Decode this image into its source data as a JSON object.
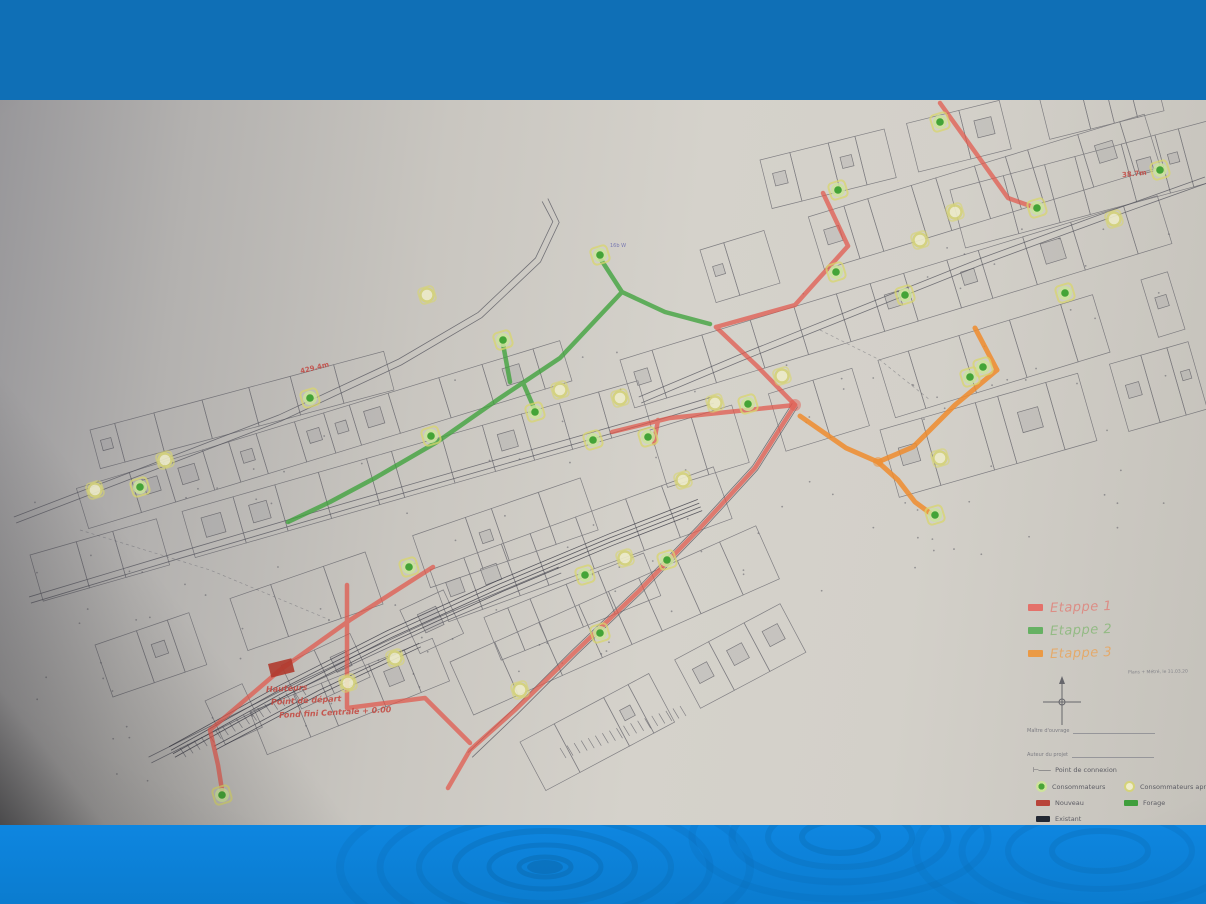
{
  "slide": {
    "top_band_color": "#0f6fb6",
    "bottom_band_color": "#0d84dc",
    "paper_color": "#d3d0c9"
  },
  "handwritten_legend": {
    "items": [
      {
        "label": "Etappe 1",
        "color": "#e8625a",
        "text_color": "#e4746c"
      },
      {
        "label": "Etappe 2",
        "color": "#53ad52",
        "text_color": "#7cb56b"
      },
      {
        "label": "Etappe 3",
        "color": "#f0922f",
        "text_color": "#ef9e47"
      }
    ]
  },
  "printed_legend": {
    "note": "Plans + Métré, le 31.03.20",
    "fields": [
      {
        "label": "Maître d'ouvrage"
      },
      {
        "label": "Auteur du projet"
      }
    ],
    "items": [
      {
        "symbol": "connection",
        "label": "Point de connexion"
      },
      {
        "symbol": "consumer-green",
        "label": "Consommateurs"
      },
      {
        "symbol": "consumer-yellow",
        "label": "Consommateurs apr"
      },
      {
        "symbol": "swatch-red",
        "label": "Nouveau",
        "color": "#b8443a"
      },
      {
        "symbol": "swatch-green",
        "label": "Forage",
        "color": "#3f9e3c"
      },
      {
        "symbol": "swatch-black",
        "label": "Existant",
        "color": "#222833"
      }
    ]
  },
  "annotations": {
    "red_notes": [
      {
        "text": "Hauteurs",
        "x": 266,
        "y": 584
      },
      {
        "text": "Point de départ",
        "x": 271,
        "y": 596
      },
      {
        "text": "Fond fini Centrale + 0.00",
        "x": 279,
        "y": 608
      }
    ],
    "measurements": [
      {
        "text": "429.4m",
        "x": 300,
        "y": 264,
        "rot": -14
      },
      {
        "text": "38.7m",
        "x": 1122,
        "y": 70,
        "rot": -6
      }
    ],
    "node_label": {
      "text": "16b W",
      "x": 610,
      "y": 143
    }
  },
  "map": {
    "reservoir_rect": {
      "x": 268,
      "y": 564,
      "w": 24,
      "h": 14,
      "color": "#b03a2e"
    },
    "routes": {
      "red": {
        "color": "#e2574b",
        "paths": [
          [
            [
              940,
              3
            ],
            [
              1008,
              98
            ],
            [
              1036,
              108
            ]
          ],
          [
            [
              823,
              93
            ],
            [
              848,
              146
            ]
          ],
          [
            [
              848,
              146
            ],
            [
              795,
              205
            ],
            [
              716,
              227
            ]
          ],
          [
            [
              716,
              227
            ],
            [
              757,
              266
            ],
            [
              795,
              305
            ]
          ],
          [
            [
              795,
              305
            ],
            [
              670,
              318
            ],
            [
              612,
              332
            ]
          ],
          [
            [
              658,
              320
            ],
            [
              654,
              343
            ]
          ],
          [
            [
              795,
              305
            ],
            [
              755,
              368
            ],
            [
              700,
              428
            ],
            [
              638,
              492
            ],
            [
              575,
              552
            ],
            [
              515,
              610
            ],
            [
              470,
              650
            ],
            [
              448,
              688
            ]
          ],
          [
            [
              347,
              485
            ],
            [
              347,
              608
            ],
            [
              425,
              598
            ],
            [
              470,
              643
            ]
          ],
          [
            [
              433,
              467
            ],
            [
              350,
              520
            ],
            [
              280,
              570
            ],
            [
              210,
              630
            ]
          ],
          [
            [
              210,
              630
            ],
            [
              218,
              665
            ],
            [
              222,
              690
            ]
          ]
        ]
      },
      "green": {
        "color": "#3fa33c",
        "paths": [
          [
            [
              600,
              158
            ],
            [
              622,
              192
            ],
            [
              665,
              212
            ],
            [
              710,
              224
            ]
          ],
          [
            [
              622,
              192
            ],
            [
              560,
              258
            ],
            [
              500,
              298
            ],
            [
              437,
              342
            ],
            [
              375,
              378
            ],
            [
              330,
              402
            ],
            [
              288,
              422
            ]
          ],
          [
            [
              503,
              244
            ],
            [
              510,
              282
            ]
          ],
          [
            [
              524,
              285
            ],
            [
              534,
              308
            ]
          ]
        ]
      },
      "orange": {
        "color": "#f08c2e",
        "paths": [
          [
            [
              975,
              228
            ],
            [
              997,
              270
            ]
          ],
          [
            [
              997,
              270
            ],
            [
              955,
              305
            ],
            [
              913,
              347
            ],
            [
              878,
              362
            ],
            [
              846,
              348
            ],
            [
              800,
              316
            ]
          ],
          [
            [
              878,
              362
            ],
            [
              898,
              380
            ],
            [
              915,
              402
            ],
            [
              930,
              413
            ]
          ]
        ]
      }
    },
    "nodes_green": [
      [
        222,
        695
      ],
      [
        140,
        387
      ],
      [
        310,
        298
      ],
      [
        431,
        336
      ],
      [
        503,
        240
      ],
      [
        535,
        312
      ],
      [
        600,
        155
      ],
      [
        648,
        337
      ],
      [
        593,
        340
      ],
      [
        409,
        467
      ],
      [
        585,
        475
      ],
      [
        600,
        533
      ],
      [
        667,
        460
      ],
      [
        836,
        172
      ],
      [
        838,
        90
      ],
      [
        940,
        22
      ],
      [
        1037,
        108
      ],
      [
        935,
        415
      ],
      [
        1065,
        193
      ],
      [
        970,
        277
      ],
      [
        983,
        267
      ],
      [
        905,
        195
      ],
      [
        748,
        304
      ],
      [
        1160,
        70
      ]
    ],
    "nodes_yellow": [
      [
        95,
        390
      ],
      [
        165,
        360
      ],
      [
        427,
        195
      ],
      [
        560,
        290
      ],
      [
        620,
        298
      ],
      [
        683,
        380
      ],
      [
        715,
        303
      ],
      [
        782,
        276
      ],
      [
        920,
        140
      ],
      [
        955,
        112
      ],
      [
        1114,
        119
      ],
      [
        348,
        583
      ],
      [
        395,
        558
      ],
      [
        520,
        590
      ],
      [
        625,
        458
      ],
      [
        940,
        358
      ]
    ]
  }
}
